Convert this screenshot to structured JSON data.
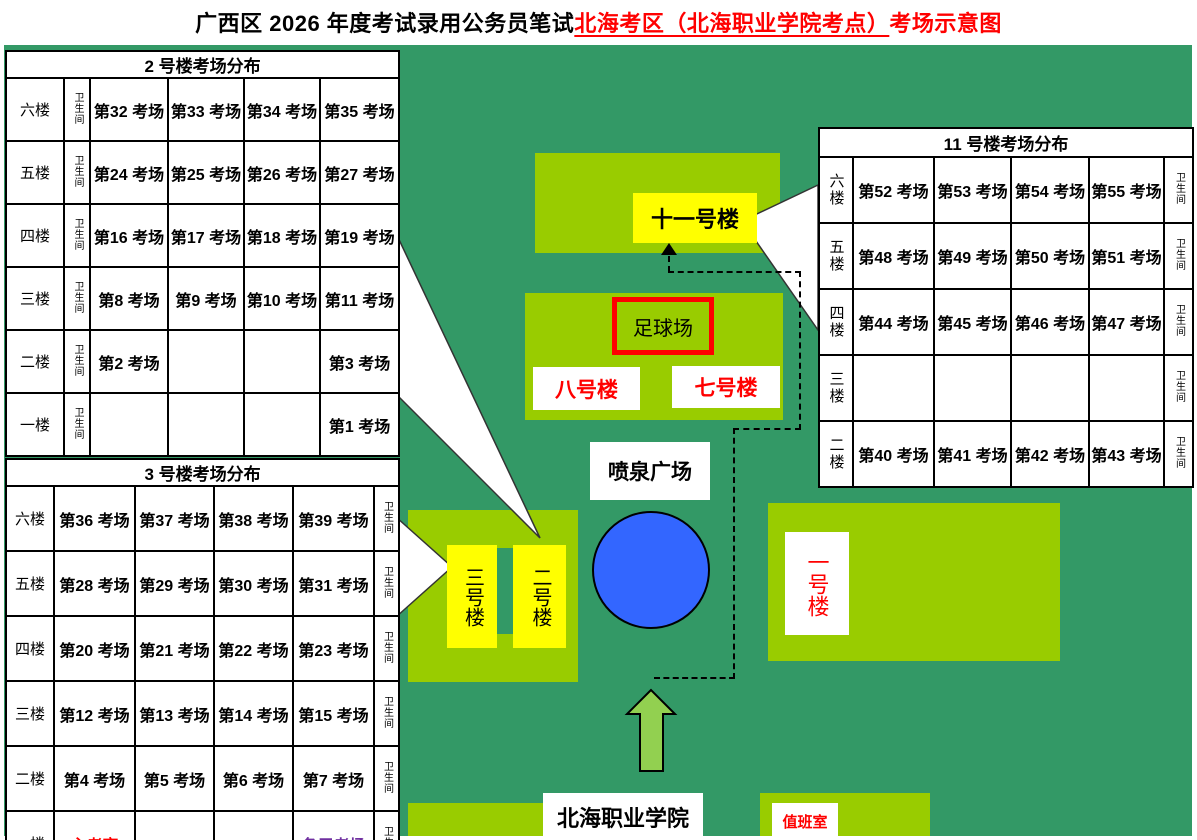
{
  "title": {
    "part_black": "广西区 2026 年度考试录用公务员笔试",
    "part_red_underlined": "北海考区（北海职业学院考点）",
    "part_red": "考场示意图"
  },
  "colors": {
    "map_bg": "#339966",
    "building_block": "#99CC00",
    "tower_yellow": "#FFFF00",
    "gate_arrow": "#92D050",
    "fountain_blue": "#3366FF",
    "accent_red": "#FF0000",
    "accent_purple": "#7030A0",
    "table_header_green": "#99CC33"
  },
  "map": {
    "building11_label": "十一号楼",
    "soccer_field": "足球场",
    "building8": "八号楼",
    "building7": "七号楼",
    "fountain": "喷泉广场",
    "tower3": "三号楼",
    "tower2": "二号楼",
    "building1": "一号楼",
    "campus_gate": "北海职业学院",
    "duty_room": "值班室"
  },
  "tables": {
    "b2": {
      "header": "2 号楼考场分布",
      "toilet_label": "卫生间",
      "rows": [
        {
          "floor": "六楼",
          "cells": [
            "第32 考场",
            "第33 考场",
            "第34 考场",
            "第35 考场"
          ]
        },
        {
          "floor": "五楼",
          "cells": [
            "第24 考场",
            "第25 考场",
            "第26 考场",
            "第27 考场"
          ]
        },
        {
          "floor": "四楼",
          "cells": [
            "第16 考场",
            "第17 考场",
            "第18 考场",
            "第19 考场"
          ]
        },
        {
          "floor": "三楼",
          "cells": [
            "第8 考场",
            "第9 考场",
            "第10 考场",
            "第11 考场"
          ]
        },
        {
          "floor": "二楼",
          "cells": [
            "第2 考场",
            "",
            "",
            "第3 考场"
          ]
        },
        {
          "floor": "一楼",
          "cells": [
            "",
            "",
            "",
            "第1 考场"
          ]
        }
      ]
    },
    "b3": {
      "header": "3 号楼考场分布",
      "toilet_label": "卫生间",
      "rows": [
        {
          "floor": "六楼",
          "cells": [
            "第36 考场",
            "第37 考场",
            "第38 考场",
            "第39 考场"
          ]
        },
        {
          "floor": "五楼",
          "cells": [
            "第28 考场",
            "第29 考场",
            "第30 考场",
            "第31 考场"
          ]
        },
        {
          "floor": "四楼",
          "cells": [
            "第20 考场",
            "第21 考场",
            "第22 考场",
            "第23 考场"
          ]
        },
        {
          "floor": "三楼",
          "cells": [
            "第12 考场",
            "第13 考场",
            "第14 考场",
            "第15 考场"
          ]
        },
        {
          "floor": "二楼",
          "cells": [
            "第4 考场",
            "第5 考场",
            "第6 考场",
            "第7 考场"
          ]
        },
        {
          "floor": "一楼",
          "cells": [
            {
              "text": "主考室",
              "color": "red"
            },
            "",
            "",
            {
              "text": "备用考场",
              "color": "purple"
            }
          ]
        }
      ]
    },
    "b11": {
      "header": "11 号楼考场分布",
      "toilet_label": "卫生间",
      "rows": [
        {
          "floor": "六楼",
          "cells": [
            "第52 考场",
            "第53 考场",
            "第54 考场",
            "第55 考场"
          ]
        },
        {
          "floor": "五楼",
          "cells": [
            "第48 考场",
            "第49 考场",
            "第50 考场",
            "第51 考场"
          ]
        },
        {
          "floor": "四楼",
          "cells": [
            "第44 考场",
            "第45 考场",
            "第46 考场",
            "第47 考场"
          ]
        },
        {
          "floor": "三楼",
          "cells": [
            "",
            "",
            "",
            ""
          ]
        },
        {
          "floor": "二楼",
          "cells": [
            "第40 考场",
            "第41 考场",
            "第42 考场",
            "第43 考场"
          ]
        }
      ]
    }
  }
}
